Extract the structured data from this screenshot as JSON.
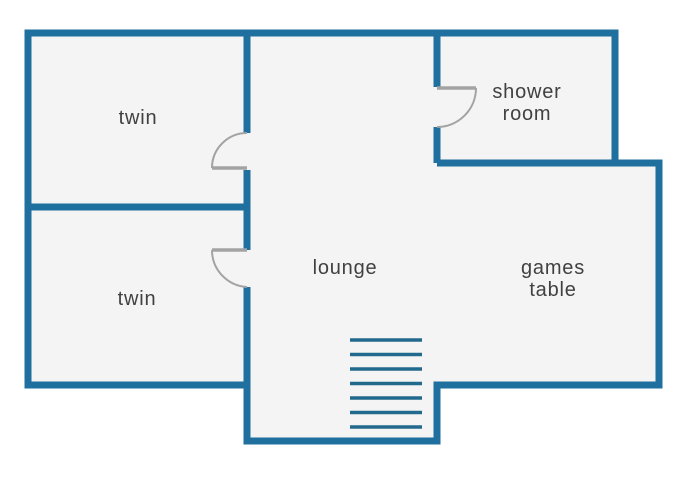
{
  "colors": {
    "wall": "#1f6f9f",
    "stairs": "#226a8d",
    "interior": "#f3f4f3",
    "background": "#ffffff",
    "door": "#a3a3a3",
    "text": "#414141"
  },
  "floorplan": {
    "canvas": {
      "width": 690,
      "height": 500
    },
    "outline": "M28 33 H615 V163 H659 V385 H437 V441 H247 V385 H28 Z",
    "walls": [
      {
        "name": "twin-divider-wall",
        "d": "M28 207 H247"
      },
      {
        "name": "lounge-west-wall-upper",
        "d": "M247 33 V133"
      },
      {
        "name": "lounge-west-wall-middle",
        "d": "M247 170 V250"
      },
      {
        "name": "lounge-west-wall-lower",
        "d": "M247 287 V441"
      },
      {
        "name": "shower-west-wall-upper",
        "d": "M437 33 V87"
      },
      {
        "name": "shower-west-wall-lower",
        "d": "M437 127 V163"
      },
      {
        "name": "shower-south-wall",
        "d": "M437 163 H659"
      }
    ],
    "doors": [
      {
        "name": "twin-1-door",
        "leaf": "M247 168 H212",
        "swing": "M212 168 A35 35 0 0 1 247 133"
      },
      {
        "name": "twin-2-door",
        "leaf": "M247 250 H212",
        "swing": "M212 250 A37 37 0 0 0 247 287"
      },
      {
        "name": "shower-door",
        "leaf": "M437 88 H476",
        "swing": "M476 88 A39 39 0 0 1 437 127"
      }
    ],
    "stairs": {
      "x1": 350,
      "x2": 422,
      "y_start": 340,
      "step": 14.5,
      "count": 7
    },
    "rooms": [
      {
        "id": "twin-1",
        "label": "twin",
        "x": 138,
        "y": 118
      },
      {
        "id": "twin-2",
        "label": "twin",
        "x": 137,
        "y": 299
      },
      {
        "id": "lounge",
        "label": "lounge",
        "x": 345,
        "y": 268
      },
      {
        "id": "shower-room",
        "label": "shower room",
        "x": 527,
        "y": 103,
        "max_width": 110
      },
      {
        "id": "games-table",
        "label": "games table",
        "x": 553,
        "y": 279,
        "max_width": 110
      }
    ]
  }
}
